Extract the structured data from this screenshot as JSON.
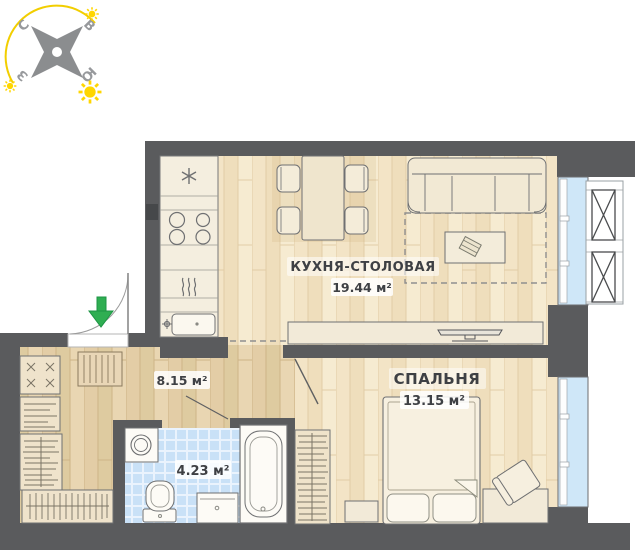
{
  "plan": {
    "rooms": {
      "kitchen": {
        "name": "КУХНЯ-СТОЛОВАЯ",
        "area": "19.44 м²"
      },
      "bedroom": {
        "name": "СПАЛЬНЯ",
        "area": "13.15 м²"
      },
      "hallway": {
        "area": "8.15 м²"
      },
      "bathroom": {
        "area": "4.23 м²"
      }
    },
    "compass": {
      "north": "С",
      "east": "В",
      "west": "З",
      "south": "Ю"
    },
    "icons": {
      "entrance_arrow": "green-down-arrow",
      "fridge": "snowflake",
      "stove": "four-burner-circles",
      "hood": "steam-waves",
      "compass_star": "four-point-star",
      "sun": "sun-with-rays",
      "ac_basket": "crossed-box"
    },
    "colors": {
      "wall": "#5a5b5d",
      "wood_light": "#f2e3c5",
      "wood_dark": "#e2cba3",
      "tile_blue": "#c9e1f7",
      "glass_blue": "#cfe7f8",
      "furniture": "#f3ecdb",
      "accent_green": "#2fae52",
      "sun_yellow": "#ffd600",
      "label_text": "#3e4044"
    }
  }
}
